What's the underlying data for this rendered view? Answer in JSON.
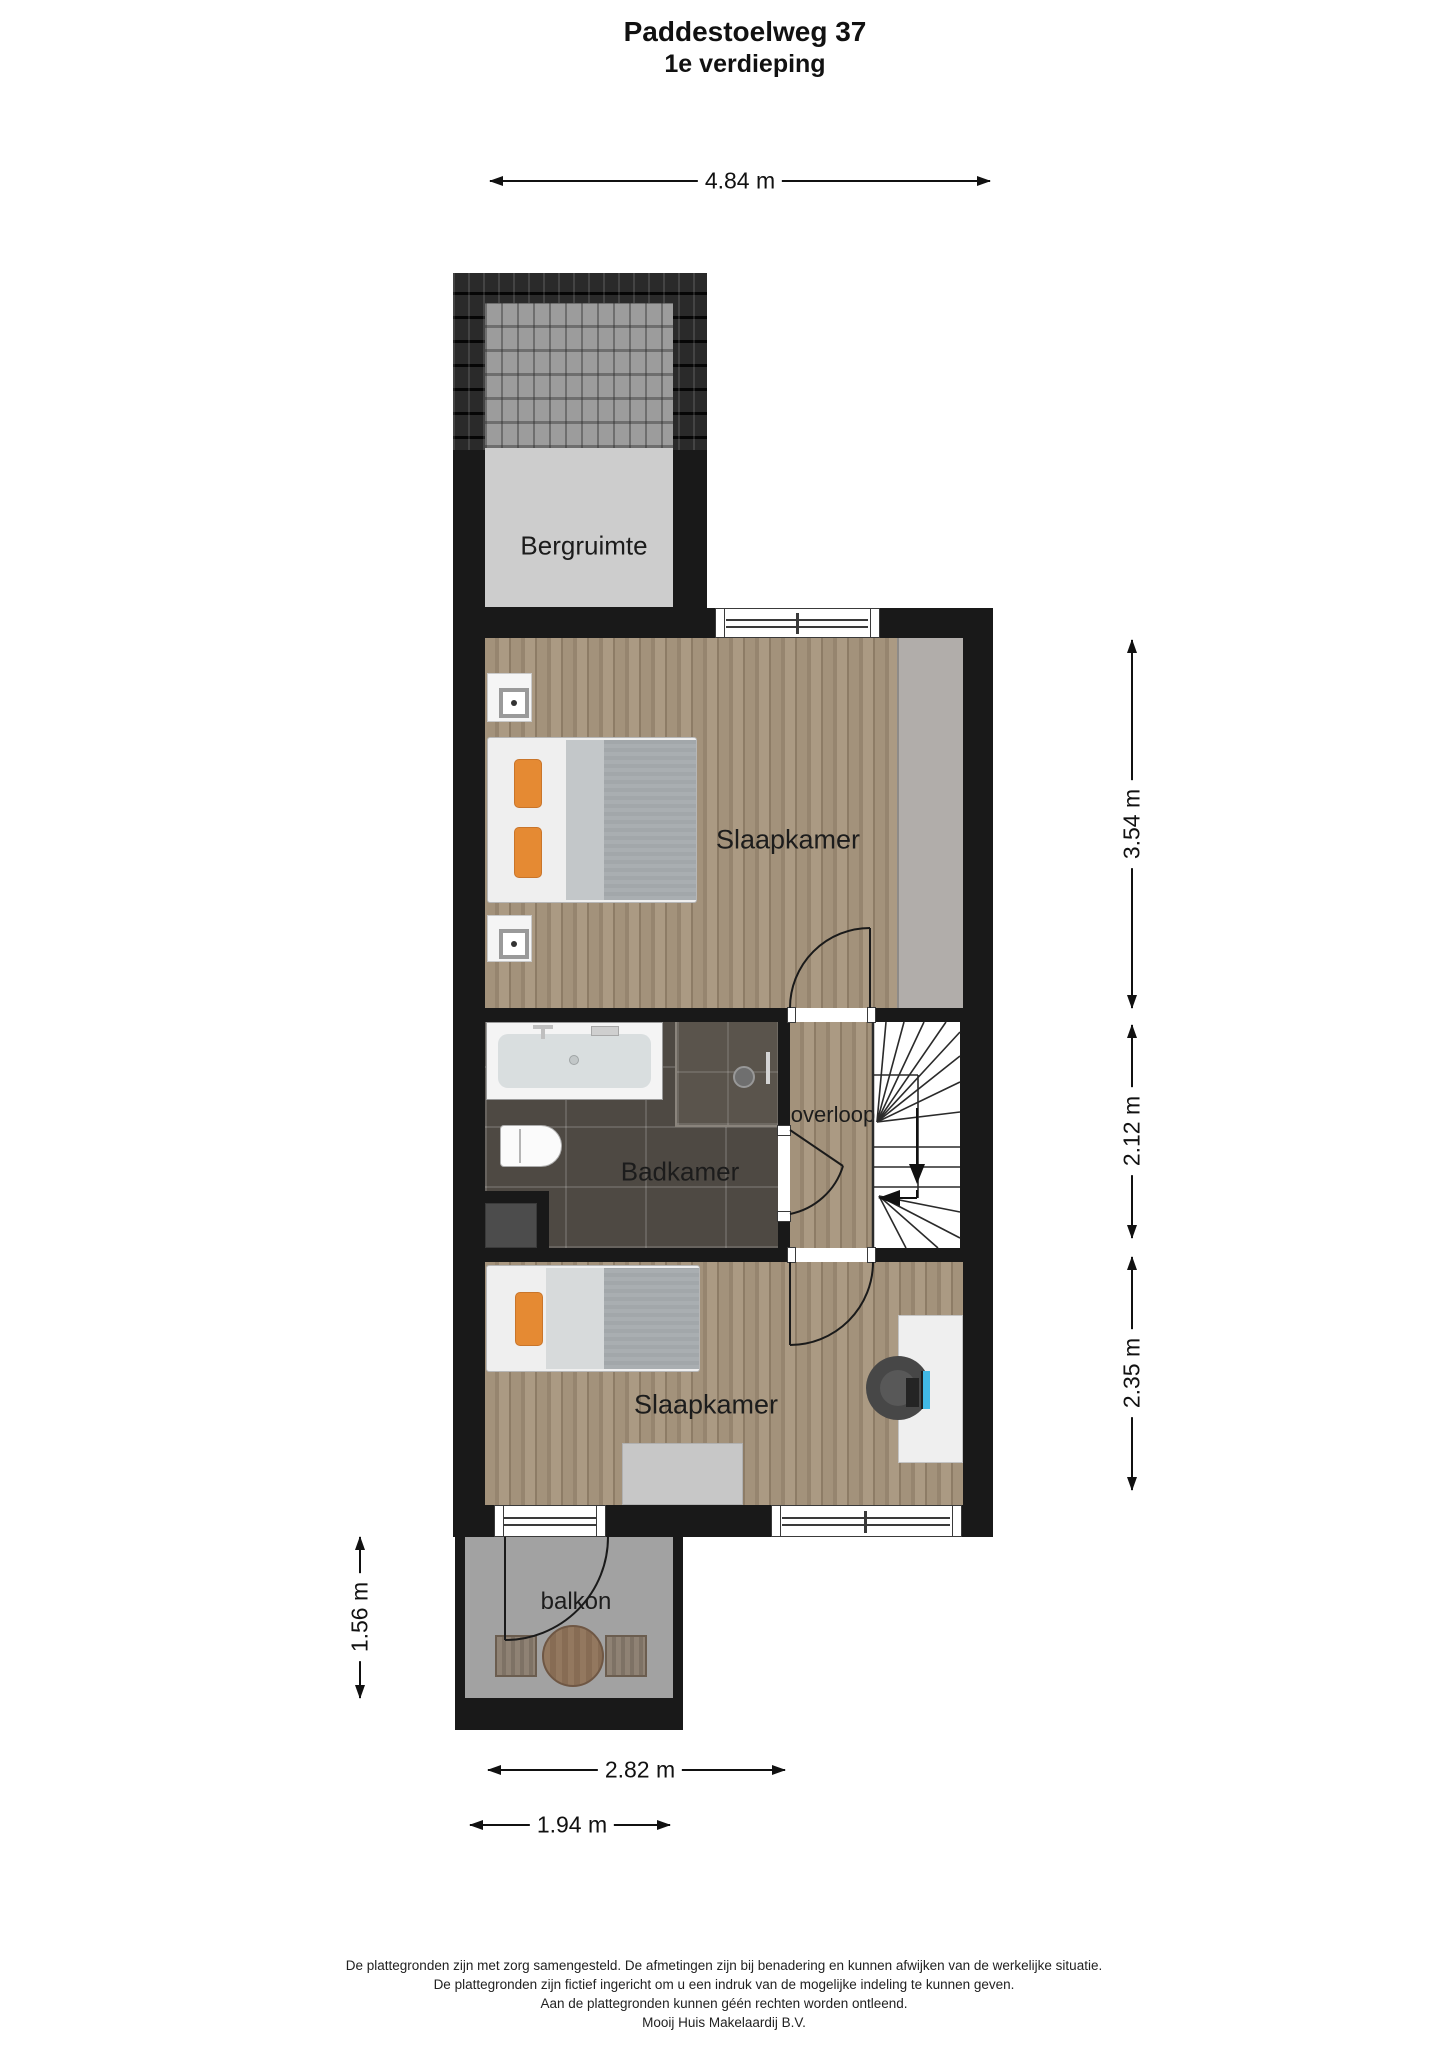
{
  "title": {
    "address": "Paddestoelweg 37",
    "floor": "1e verdieping"
  },
  "rooms": {
    "storage": "Bergruimte",
    "bedroom_top": "Slaapkamer",
    "bathroom": "Badkamer",
    "landing": "overloop",
    "bedroom_bottom": "Slaapkamer",
    "balcony": "balkon"
  },
  "dimensions": {
    "top_width": "4.84 m",
    "bedroom_top_depth": "3.54 m",
    "middle_depth": "2.12 m",
    "bedroom_bottom_depth": "2.35 m",
    "balcony_depth": "1.56 m",
    "bottom_width": "2.82 m",
    "balcony_width": "1.94 m"
  },
  "footer": {
    "line1": "De plattegronden zijn met zorg samengesteld. De afmetingen zijn bij benadering en kunnen afwijken van de werkelijke situatie.",
    "line2": "De plattegronden zijn fictief ingericht om u een indruk van de mogelijke indeling te kunnen geven.",
    "line3": "Aan de plattegronden kunnen géén rechten worden ontleend.",
    "line4": "Mooij Huis Makelaardij B.V."
  },
  "colors": {
    "wall": "#191919",
    "wood": "#a3927b",
    "bathroom_tile": "#4e4943",
    "closet": "#b1adaa",
    "balcony_floor": "#a2a2a2",
    "storage_floor": "#cdcdcd",
    "pillow_orange": "#e58a33",
    "monitor_blue": "#41b9e6"
  }
}
